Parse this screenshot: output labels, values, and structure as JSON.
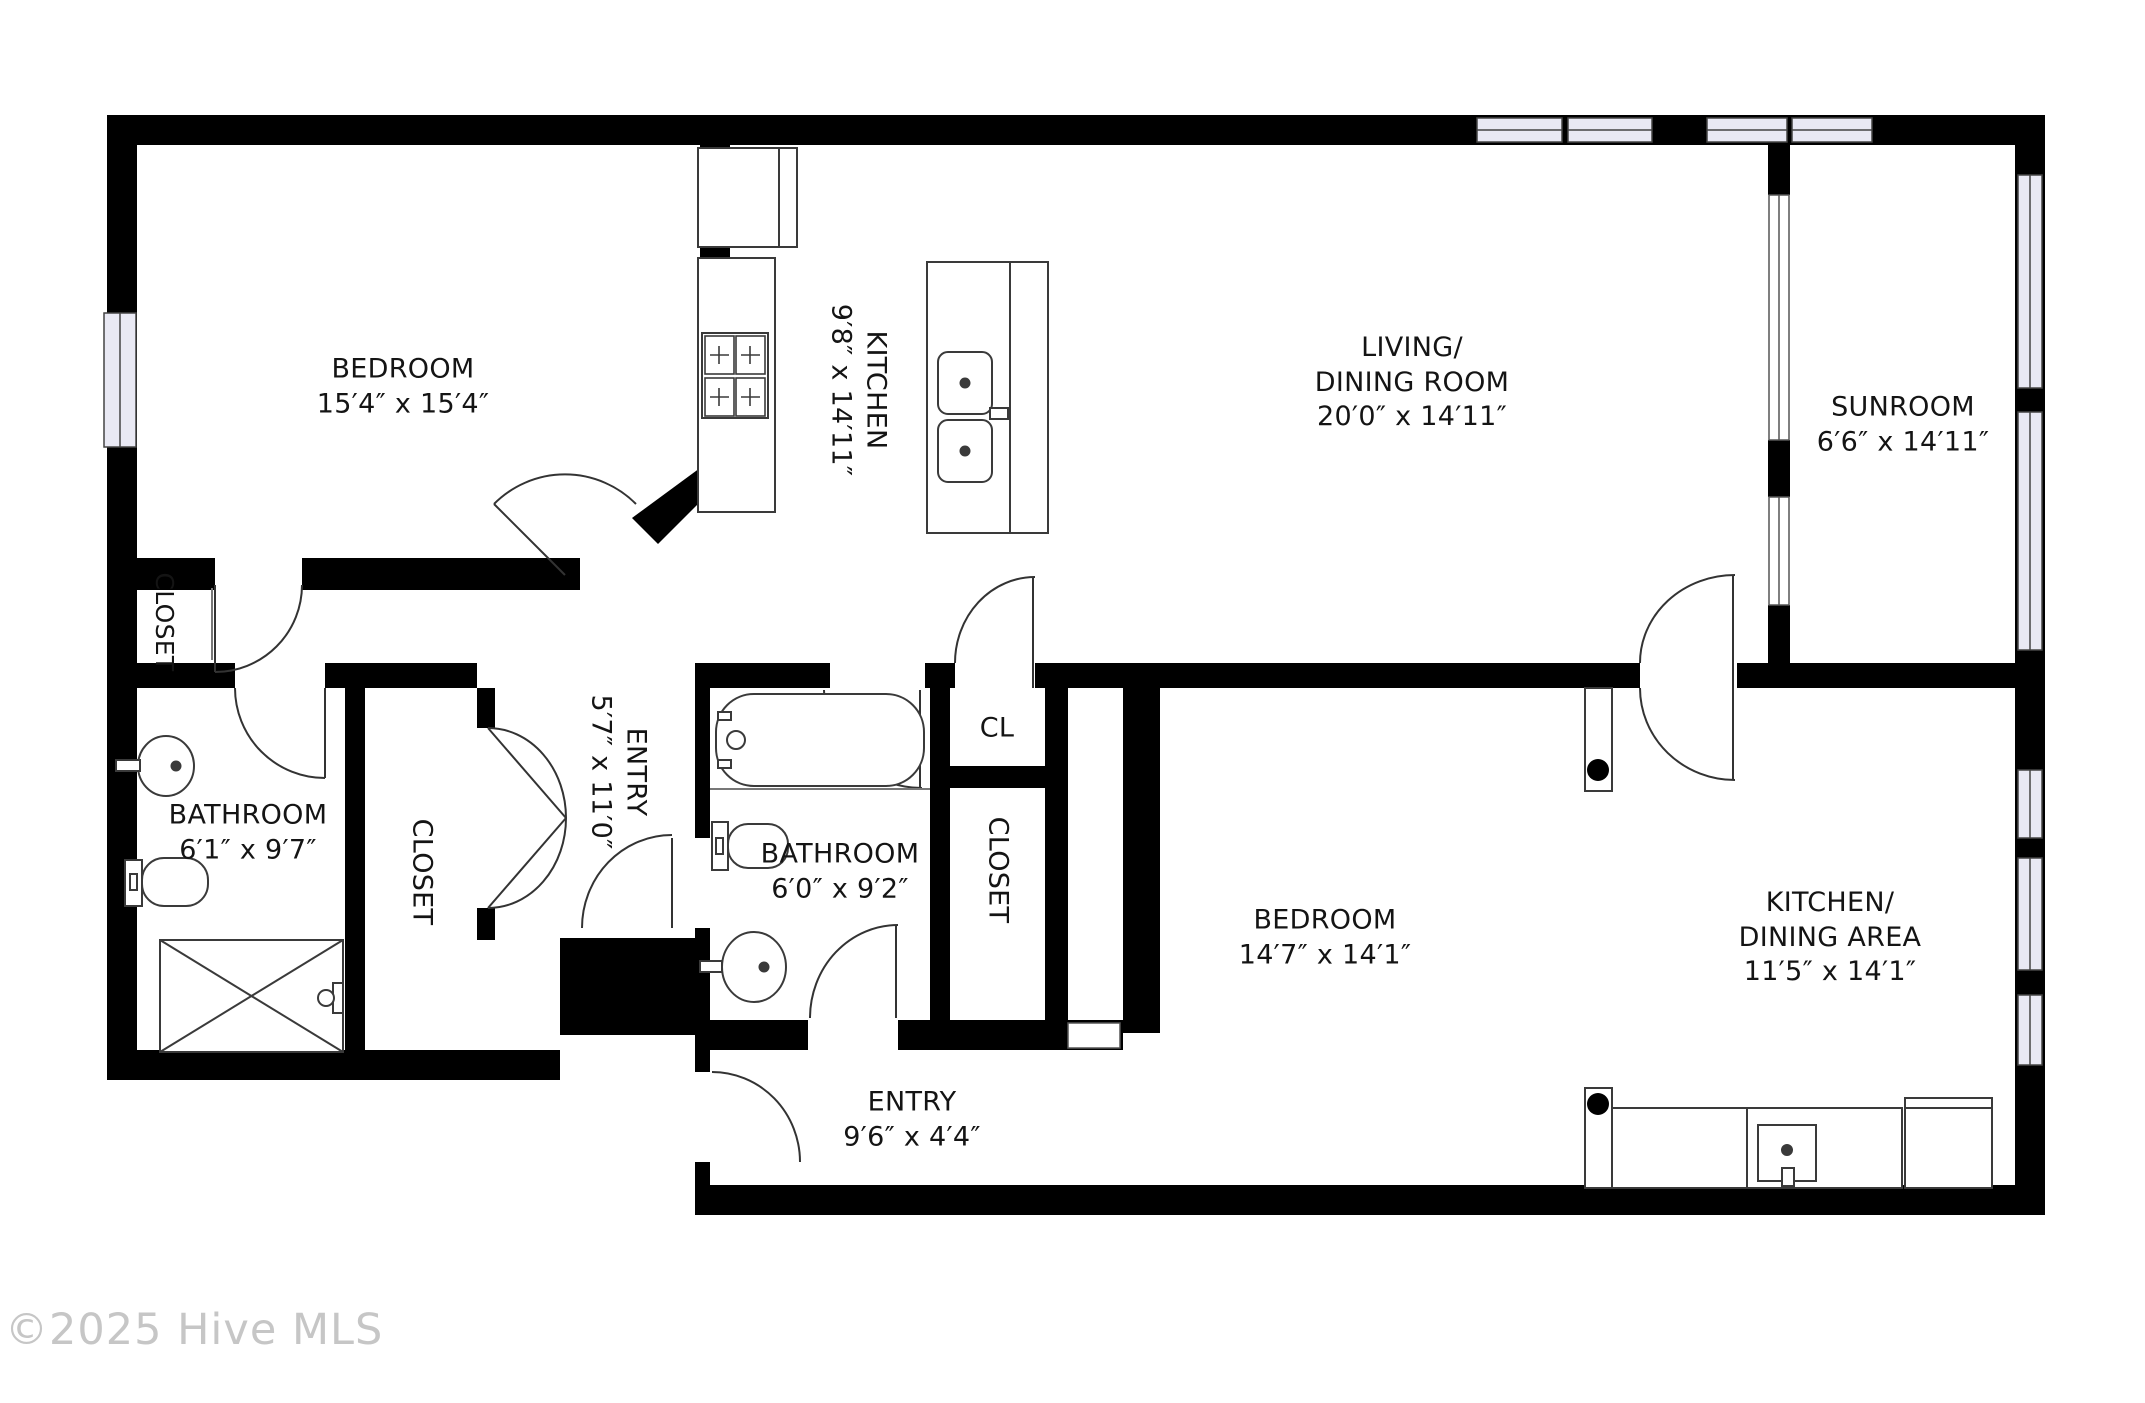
{
  "plan_title": "Condo floor plan",
  "rooms": {
    "bedroom1": {
      "name": "BEDROOM",
      "size": "15′4″ x 15′4″"
    },
    "kitchen": {
      "name": "KITCHEN",
      "size": "9′8″ x 14′11″"
    },
    "living": {
      "name1": "LIVING/",
      "name2": "DINING ROOM",
      "size": "20′0″ x 14′11″"
    },
    "sunroom": {
      "name": "SUNROOM",
      "size": "6′6″ x 14′11″"
    },
    "closet_bedroom1": {
      "name": "CLOSET"
    },
    "bathroom1": {
      "name": "BATHROOM",
      "size": "6′1″ x 9′7″"
    },
    "closet_hall": {
      "name": "CLOSET"
    },
    "entry_hall": {
      "name": "ENTRY",
      "size": "5′7″ x 11′0″"
    },
    "bathroom2": {
      "name": "BATHROOM",
      "size": "6′0″ x 9′2″"
    },
    "cl": {
      "name": "CL"
    },
    "closet_bedroom2": {
      "name": "CLOSET"
    },
    "bedroom2": {
      "name": "BEDROOM",
      "size": "14′7″ x 14′1″"
    },
    "kitchen_dining": {
      "name1": "KITCHEN/",
      "name2": "DINING AREA",
      "size": "11′5″ x 14′1″"
    },
    "entry2": {
      "name": "ENTRY",
      "size": "9′6″ x 4′4″"
    }
  },
  "watermark": "©2025 Hive MLS",
  "colors": {
    "wall": "#000000",
    "window_fill": "#e9e9f4",
    "text": "#141414",
    "watermark": "#c6c6c6"
  }
}
